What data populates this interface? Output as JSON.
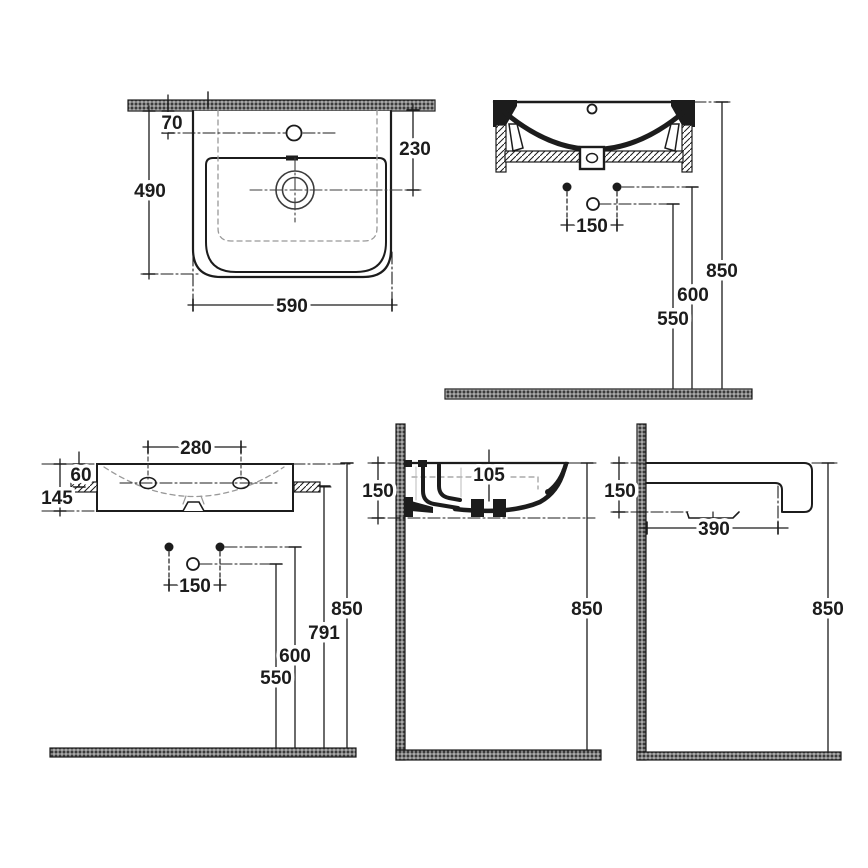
{
  "drawing": {
    "type": "technical-installation-drawing",
    "subject": "wall-hung-washbasin",
    "colors": {
      "line": "#1c1c1c",
      "hidden_line": "#999999",
      "hatch_dark": "#3b3b3b",
      "background": "#ffffff"
    },
    "views": {
      "plan": {
        "dims": {
          "d70": "70",
          "d230": "230",
          "d490": "490",
          "d590": "590"
        }
      },
      "front_section": {
        "dims": {
          "d150": "150",
          "d550": "550",
          "d600": "600",
          "d850": "850"
        }
      },
      "front_install": {
        "dims": {
          "d280": "280",
          "d60": "60",
          "d145": "145",
          "d150": "150",
          "d550": "550",
          "d600": "600",
          "d791": "791",
          "d850": "850"
        }
      },
      "side_section": {
        "dims": {
          "d105": "105",
          "d150": "150",
          "d850": "850"
        }
      },
      "side_profile": {
        "dims": {
          "d150": "150",
          "d390": "390",
          "d850": "850"
        }
      }
    }
  }
}
